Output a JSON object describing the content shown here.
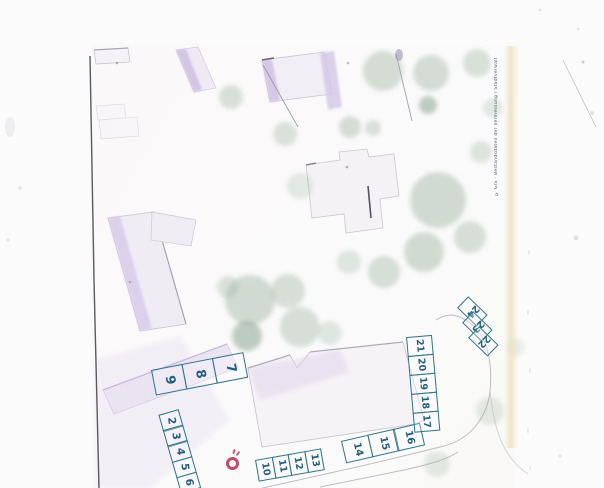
{
  "page": {
    "width": 604,
    "height": 488,
    "background": "#fcfbfc"
  },
  "map": {
    "frame_line_color": "#45424a",
    "building_fill": "#f3eff5",
    "building_accent": "#d0c3e4",
    "tree_color": "#a3b8a6",
    "tree_color_dark": "#8aa58f"
  },
  "parking": {
    "outline_color": "#2e7389",
    "number_color": "#225f7e",
    "groups": [
      {
        "id": "row-7-9",
        "numbers": [
          "9",
          "8",
          "7"
        ]
      },
      {
        "id": "diagonal-2-6",
        "numbers": [
          "2",
          "3",
          "4",
          "5",
          "6"
        ]
      },
      {
        "id": "row-10-13",
        "numbers": [
          "10",
          "11",
          "12",
          "13"
        ]
      },
      {
        "id": "row-14-16",
        "numbers": [
          "14",
          "15",
          "16"
        ]
      },
      {
        "id": "column-17-21",
        "numbers": [
          "21",
          "20",
          "19",
          "18",
          "17"
        ]
      },
      {
        "id": "corner-22-24",
        "numbers": [
          "24",
          "23",
          "22"
        ]
      }
    ]
  },
  "marker": {
    "shape": "hand-drawn-circle",
    "color": "#c23a5e"
  },
  "edge": {
    "band_color": "rgba(233,224,185,0.75)",
    "microtext": "© GIS - Bestandsdaten der Vermessung / Stadtverwaltung"
  },
  "trees": [
    {
      "x": 231,
      "y": 97,
      "r": 12,
      "o": 0.4
    },
    {
      "x": 285,
      "y": 134,
      "r": 12,
      "o": 0.38
    },
    {
      "x": 350,
      "y": 127,
      "r": 11,
      "o": 0.45
    },
    {
      "x": 383,
      "y": 71,
      "r": 20,
      "o": 0.45
    },
    {
      "x": 431,
      "y": 73,
      "r": 18,
      "o": 0.45
    },
    {
      "x": 477,
      "y": 63,
      "r": 14,
      "o": 0.4
    },
    {
      "x": 428,
      "y": 105,
      "r": 9,
      "o": 0.55,
      "dark": true
    },
    {
      "x": 373,
      "y": 128,
      "r": 8,
      "o": 0.4
    },
    {
      "x": 493,
      "y": 108,
      "r": 10,
      "o": 0.28
    },
    {
      "x": 481,
      "y": 152,
      "r": 11,
      "o": 0.35
    },
    {
      "x": 300,
      "y": 186,
      "r": 13,
      "o": 0.28
    },
    {
      "x": 438,
      "y": 200,
      "r": 28,
      "o": 0.48
    },
    {
      "x": 470,
      "y": 237,
      "r": 16,
      "o": 0.42
    },
    {
      "x": 424,
      "y": 252,
      "r": 20,
      "o": 0.48
    },
    {
      "x": 384,
      "y": 272,
      "r": 16,
      "o": 0.42
    },
    {
      "x": 349,
      "y": 262,
      "r": 12,
      "o": 0.32
    },
    {
      "x": 250,
      "y": 300,
      "r": 25,
      "o": 0.48
    },
    {
      "x": 288,
      "y": 291,
      "r": 17,
      "o": 0.42
    },
    {
      "x": 228,
      "y": 287,
      "r": 11,
      "o": 0.38
    },
    {
      "x": 247,
      "y": 336,
      "r": 15,
      "o": 0.55,
      "dark": true
    },
    {
      "x": 300,
      "y": 327,
      "r": 20,
      "o": 0.42
    },
    {
      "x": 330,
      "y": 333,
      "r": 12,
      "o": 0.32
    },
    {
      "x": 490,
      "y": 411,
      "r": 14,
      "o": 0.28
    },
    {
      "x": 437,
      "y": 464,
      "r": 13,
      "o": 0.28
    },
    {
      "x": 516,
      "y": 347,
      "r": 9,
      "o": 0.2
    }
  ]
}
